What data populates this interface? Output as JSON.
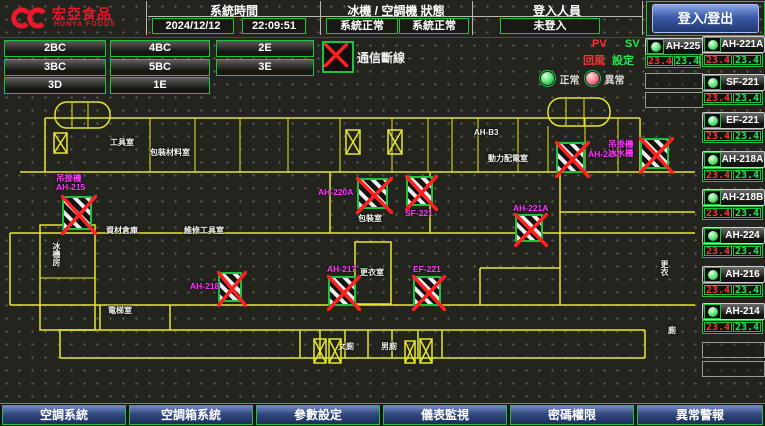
{
  "header": {
    "logo_title": "宏亞食品",
    "logo_subtitle": "HUNYA FOODS",
    "sections": [
      {
        "label": "系統時間",
        "values": [
          "2024/12/12",
          "22:09:51"
        ]
      },
      {
        "label": "冰機 / 空調機 狀態",
        "values": [
          "系統正常",
          "系統正常"
        ]
      },
      {
        "label": "登入人員",
        "values": [
          "未登入"
        ]
      }
    ],
    "login_button": "登入/登出"
  },
  "zones": {
    "buttons": [
      "2BC",
      "4BC",
      "2E",
      "3BC",
      "5BC",
      "3E",
      "3D",
      "1E"
    ]
  },
  "comm_status": {
    "label": "通信斷線"
  },
  "legend": {
    "pv": "PV",
    "sv": "SV",
    "pv_desc": "回風",
    "sv_desc": "設定",
    "normal": "正常",
    "abnormal": "異常"
  },
  "units": {
    "left": [
      {
        "name": "AH-225",
        "pv": "23.4",
        "sv": "23.4"
      }
    ],
    "left_empty_slots": 2,
    "right": [
      {
        "name": "AH-221A",
        "pv": "23.4",
        "sv": "23.4"
      },
      {
        "name": "SF-221",
        "pv": "23.4",
        "sv": "23.4"
      },
      {
        "name": "EF-221",
        "pv": "23.4",
        "sv": "23.4"
      },
      {
        "name": "AH-218A",
        "pv": "23.4",
        "sv": "23.4"
      },
      {
        "name": "AH-218B",
        "pv": "23.4",
        "sv": "23.4"
      },
      {
        "name": "AH-224",
        "pv": "23.4",
        "sv": "23.4"
      },
      {
        "name": "AH-216",
        "pv": "23.4",
        "sv": "23.4"
      },
      {
        "name": "AH-214",
        "pv": "23.4",
        "sv": "23.4"
      }
    ],
    "right_empty_slots": 2
  },
  "map": {
    "equipment": [
      {
        "id": "AH-215",
        "lines": [
          "吊掛機",
          "AH-215"
        ],
        "box": [
          62,
          104,
          30,
          34
        ],
        "label": [
          56,
          82
        ]
      },
      {
        "id": "AH-220A",
        "lines": [
          "AH-220A"
        ],
        "box": [
          357,
          86,
          31,
          31
        ],
        "label": [
          318,
          96
        ]
      },
      {
        "id": "SF-221",
        "lines": [
          "SF-221"
        ],
        "box": [
          406,
          84,
          27,
          30
        ],
        "label": [
          405,
          117
        ]
      },
      {
        "id": "AH-214",
        "lines": [
          "AH-214"
        ],
        "box": [
          556,
          50,
          29,
          31
        ],
        "label": [
          588,
          58
        ]
      },
      {
        "id": "chiller",
        "lines": [
          "吊掛機",
          "冰水機"
        ],
        "box": [
          640,
          46,
          29,
          31
        ],
        "label": [
          608,
          48
        ]
      },
      {
        "id": "AH-218",
        "lines": [
          "AH-218"
        ],
        "box": [
          218,
          180,
          24,
          30
        ],
        "label": [
          190,
          190
        ]
      },
      {
        "id": "AH-217",
        "lines": [
          "AH-217"
        ],
        "box": [
          328,
          184,
          28,
          30
        ],
        "label": [
          327,
          173
        ]
      },
      {
        "id": "EF-221",
        "lines": [
          "EF-221"
        ],
        "box": [
          413,
          184,
          28,
          30
        ],
        "label": [
          413,
          173
        ]
      },
      {
        "id": "AH-221A",
        "lines": [
          "AH-221A"
        ],
        "box": [
          515,
          122,
          28,
          28
        ],
        "label": [
          513,
          112
        ]
      }
    ],
    "rooms": [
      {
        "text": "工具室",
        "x": 110,
        "y": 46
      },
      {
        "text": "包裝材料室",
        "x": 150,
        "y": 56
      },
      {
        "text": "AH-B3",
        "x": 474,
        "y": 36
      },
      {
        "text": "動力配電室",
        "x": 488,
        "y": 62
      },
      {
        "text": "資材倉庫",
        "x": 106,
        "y": 134
      },
      {
        "text": "維修工具室",
        "x": 184,
        "y": 134
      },
      {
        "text": "包裝室",
        "x": 358,
        "y": 122
      },
      {
        "text": "更衣室",
        "x": 360,
        "y": 176
      },
      {
        "text": "電梯室",
        "x": 108,
        "y": 214
      },
      {
        "text": "女廁",
        "x": 338,
        "y": 250
      },
      {
        "text": "男廁",
        "x": 381,
        "y": 250
      },
      {
        "text": "冰機房",
        "x": 52,
        "y": 150,
        "vertical": true
      },
      {
        "text": "更衣",
        "x": 660,
        "y": 168,
        "vertical": true
      },
      {
        "text": "廁",
        "x": 668,
        "y": 234
      }
    ],
    "stair_marks": [
      [
        345,
        37,
        16,
        26
      ],
      [
        387,
        37,
        16,
        26
      ],
      [
        53,
        40,
        15,
        22
      ],
      [
        313,
        246,
        14,
        26
      ],
      [
        328,
        246,
        14,
        26
      ],
      [
        404,
        248,
        12,
        24
      ],
      [
        419,
        246,
        14,
        26
      ]
    ],
    "stair_ovals": [
      [
        55,
        10,
        55,
        26
      ],
      [
        548,
        6,
        62,
        28
      ]
    ]
  },
  "nav": {
    "buttons": [
      "空調系統",
      "空調箱系統",
      "參數設定",
      "儀表監視",
      "密碼權限",
      "異常警報"
    ]
  },
  "colors": {
    "accent_green": "#1fc23f",
    "alarm_red": "#ff2020",
    "magenta": "#ff35ff",
    "wall_yellow": "#e6e62e",
    "pv_red": "#ff3030",
    "sv_green": "#29e24f",
    "nav_blue": "#31497e",
    "logo_red": "#e8192c"
  }
}
